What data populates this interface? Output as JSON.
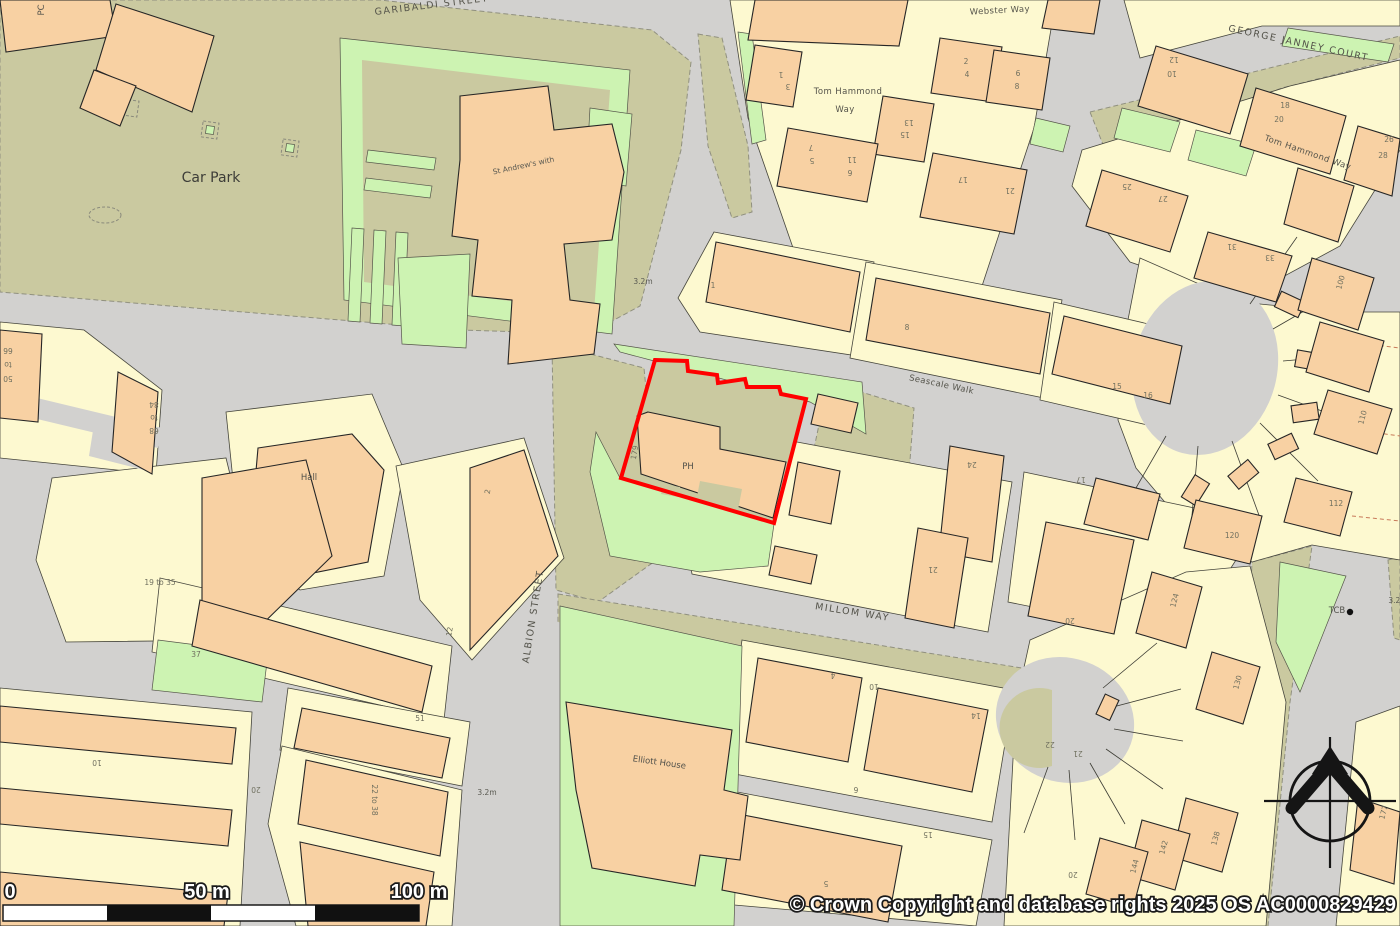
{
  "map": {
    "type": "ordnance-survey-site-plan",
    "copyright": "© Crown Copyright and database rights 2025 OS AC0000829429",
    "site": {
      "reference": "179",
      "building_label": "PH",
      "boundary_color": "#ff0000"
    },
    "streets": [
      "GARIBALDI STREET",
      "Webster Way",
      "GEORGE JANNEY COURT",
      "Tom Hammond Way",
      "Seascale Walk",
      "MILLOM WAY",
      "ALBION STREET"
    ],
    "places": [
      "Car Park",
      "St Andrew's with",
      "Hall",
      "Elliott House",
      "PC",
      "PH",
      "TCB"
    ],
    "spot_heights": [
      "3.2m"
    ]
  },
  "scale_bar": {
    "start": "0",
    "mid": "50 m",
    "end": "100 m"
  },
  "palette": {
    "road": "#d2d1cf",
    "parcel_khaki": "#cac9a0",
    "building_cream": "#fdf9d0",
    "building_orange": "#f8d1a3",
    "green_space": "#cdf3b2",
    "outline": "#262626",
    "boundary_red": "#ff0000"
  },
  "map_labels": [
    {
      "t": "GARIBALDI STREET",
      "x": 432,
      "y": 8,
      "r": -7,
      "c": "street"
    },
    {
      "t": "Webster Way",
      "x": 1000,
      "y": 13,
      "r": -3,
      "c": "street-sm"
    },
    {
      "t": "GEORGE JANNEY COURT",
      "x": 1298,
      "y": 46,
      "r": 12,
      "c": "street"
    },
    {
      "t": "Tom Hammond Way",
      "x": 1307,
      "y": 155,
      "r": 19,
      "c": "street-sm"
    },
    {
      "t": "Tom Hammond",
      "x": 848,
      "y": 94,
      "r": 0,
      "c": "street-sm"
    },
    {
      "t": "Way",
      "x": 845,
      "y": 112,
      "r": 0,
      "c": "street-sm"
    },
    {
      "t": "Seascale Walk",
      "x": 941,
      "y": 387,
      "r": 12,
      "c": "street-sm"
    },
    {
      "t": "MILLOM WAY",
      "x": 852,
      "y": 615,
      "r": 9,
      "c": "street"
    },
    {
      "t": "ALBION STREET",
      "x": 536,
      "y": 617,
      "r": -81,
      "c": "street"
    },
    {
      "t": "Car Park",
      "x": 211,
      "y": 182,
      "r": 0,
      "c": "area"
    },
    {
      "t": "St Andrew's with",
      "x": 524,
      "y": 168,
      "r": -12,
      "c": "tiny"
    },
    {
      "t": "Hall",
      "x": 309,
      "y": 480,
      "r": 0,
      "c": "small"
    },
    {
      "t": "Elliott House",
      "x": 659,
      "y": 765,
      "r": 8,
      "c": "small"
    },
    {
      "t": "PC",
      "x": 44,
      "y": 10,
      "r": -90,
      "c": "small"
    },
    {
      "t": "PH",
      "x": 688,
      "y": 469,
      "r": 0,
      "c": "small"
    },
    {
      "t": "TCB",
      "x": 1337,
      "y": 613,
      "r": 0,
      "c": "small"
    },
    {
      "t": "179",
      "x": 637,
      "y": 453,
      "r": -80,
      "c": "num"
    },
    {
      "t": "3.2m",
      "x": 643,
      "y": 284,
      "r": 0,
      "c": "tiny"
    },
    {
      "t": "3.2m",
      "x": 487,
      "y": 795,
      "r": 0,
      "c": "tiny"
    },
    {
      "t": "3.2m",
      "x": 1398,
      "y": 603,
      "r": 0,
      "c": "tiny"
    },
    {
      "t": "19 to 35",
      "x": 160,
      "y": 585,
      "r": 0,
      "c": "num"
    },
    {
      "t": "37",
      "x": 196,
      "y": 657,
      "r": 0,
      "c": "num"
    },
    {
      "t": "51",
      "x": 420,
      "y": 721,
      "r": 0,
      "c": "num"
    },
    {
      "t": "22 to 38",
      "x": 372,
      "y": 800,
      "r": 90,
      "c": "num"
    },
    {
      "t": "66",
      "x": 8,
      "y": 348,
      "r": 180,
      "c": "num"
    },
    {
      "t": "to",
      "x": 8,
      "y": 362,
      "r": 180,
      "c": "num"
    },
    {
      "t": "50",
      "x": 8,
      "y": 376,
      "r": 180,
      "c": "num"
    },
    {
      "t": "84",
      "x": 154,
      "y": 402,
      "r": 180,
      "c": "num"
    },
    {
      "t": "to",
      "x": 154,
      "y": 415,
      "r": 180,
      "c": "num"
    },
    {
      "t": "68",
      "x": 154,
      "y": 428,
      "r": 180,
      "c": "num"
    },
    {
      "t": "2",
      "x": 490,
      "y": 492,
      "r": -80,
      "c": "num"
    },
    {
      "t": "12",
      "x": 452,
      "y": 632,
      "r": -80,
      "c": "num"
    },
    {
      "t": "10",
      "x": 97,
      "y": 760,
      "r": 180,
      "c": "num"
    },
    {
      "t": "20",
      "x": 256,
      "y": 787,
      "r": 180,
      "c": "num"
    },
    {
      "t": "1",
      "x": 781,
      "y": 72,
      "r": 180,
      "c": "num"
    },
    {
      "t": "3",
      "x": 788,
      "y": 84,
      "r": 180,
      "c": "num"
    },
    {
      "t": "2",
      "x": 966,
      "y": 64,
      "r": 0,
      "c": "num"
    },
    {
      "t": "4",
      "x": 967,
      "y": 77,
      "r": 0,
      "c": "num"
    },
    {
      "t": "6",
      "x": 1018,
      "y": 76,
      "r": 0,
      "c": "num"
    },
    {
      "t": "8",
      "x": 1017,
      "y": 89,
      "r": 0,
      "c": "num"
    },
    {
      "t": "13",
      "x": 909,
      "y": 120,
      "r": 180,
      "c": "num"
    },
    {
      "t": "15",
      "x": 905,
      "y": 132,
      "r": 180,
      "c": "num"
    },
    {
      "t": "7",
      "x": 811,
      "y": 145,
      "r": 180,
      "c": "num"
    },
    {
      "t": "5",
      "x": 812,
      "y": 158,
      "r": 180,
      "c": "num"
    },
    {
      "t": "11",
      "x": 852,
      "y": 157,
      "r": 180,
      "c": "num"
    },
    {
      "t": "6",
      "x": 850,
      "y": 170,
      "r": 180,
      "c": "num"
    },
    {
      "t": "17",
      "x": 963,
      "y": 177,
      "r": 180,
      "c": "num"
    },
    {
      "t": "21",
      "x": 1010,
      "y": 188,
      "r": 180,
      "c": "num"
    },
    {
      "t": "12",
      "x": 1174,
      "y": 57,
      "r": 180,
      "c": "num"
    },
    {
      "t": "10",
      "x": 1172,
      "y": 71,
      "r": 180,
      "c": "num"
    },
    {
      "t": "18",
      "x": 1285,
      "y": 108,
      "r": 0,
      "c": "num"
    },
    {
      "t": "20",
      "x": 1279,
      "y": 122,
      "r": 0,
      "c": "num"
    },
    {
      "t": "26",
      "x": 1389,
      "y": 142,
      "r": 0,
      "c": "num"
    },
    {
      "t": "28",
      "x": 1383,
      "y": 158,
      "r": 0,
      "c": "num"
    },
    {
      "t": "25",
      "x": 1127,
      "y": 184,
      "r": 180,
      "c": "num"
    },
    {
      "t": "27",
      "x": 1163,
      "y": 196,
      "r": 180,
      "c": "num"
    },
    {
      "t": "31",
      "x": 1232,
      "y": 244,
      "r": 180,
      "c": "num"
    },
    {
      "t": "33",
      "x": 1270,
      "y": 255,
      "r": 180,
      "c": "num"
    },
    {
      "t": "100",
      "x": 1343,
      "y": 283,
      "r": -75,
      "c": "num"
    },
    {
      "t": "110",
      "x": 1365,
      "y": 418,
      "r": -75,
      "c": "num"
    },
    {
      "t": "112",
      "x": 1336,
      "y": 506,
      "r": 0,
      "c": "num"
    },
    {
      "t": "120",
      "x": 1232,
      "y": 538,
      "r": 0,
      "c": "num"
    },
    {
      "t": "8",
      "x": 907,
      "y": 330,
      "r": 0,
      "c": "num"
    },
    {
      "t": "1",
      "x": 713,
      "y": 288,
      "r": 0,
      "c": "num"
    },
    {
      "t": "15",
      "x": 1117,
      "y": 389,
      "r": 0,
      "c": "num"
    },
    {
      "t": "16",
      "x": 1148,
      "y": 398,
      "r": 0,
      "c": "num"
    },
    {
      "t": "24",
      "x": 972,
      "y": 462,
      "r": 180,
      "c": "num"
    },
    {
      "t": "21",
      "x": 933,
      "y": 567,
      "r": 180,
      "c": "num"
    },
    {
      "t": "17",
      "x": 1081,
      "y": 477,
      "r": 180,
      "c": "num"
    },
    {
      "t": "20",
      "x": 1070,
      "y": 618,
      "r": 180,
      "c": "num"
    },
    {
      "t": "22",
      "x": 1050,
      "y": 742,
      "r": 180,
      "c": "num"
    },
    {
      "t": "21",
      "x": 1078,
      "y": 751,
      "r": 180,
      "c": "num"
    },
    {
      "t": "124",
      "x": 1177,
      "y": 601,
      "r": -75,
      "c": "num"
    },
    {
      "t": "130",
      "x": 1240,
      "y": 683,
      "r": -75,
      "c": "num"
    },
    {
      "t": "138",
      "x": 1218,
      "y": 839,
      "r": -75,
      "c": "num"
    },
    {
      "t": "142",
      "x": 1166,
      "y": 848,
      "r": -75,
      "c": "num"
    },
    {
      "t": "144",
      "x": 1137,
      "y": 867,
      "r": -75,
      "c": "num"
    },
    {
      "t": "4",
      "x": 833,
      "y": 673,
      "r": 180,
      "c": "num"
    },
    {
      "t": "10",
      "x": 874,
      "y": 684,
      "r": 180,
      "c": "num"
    },
    {
      "t": "14",
      "x": 976,
      "y": 713,
      "r": 180,
      "c": "num"
    },
    {
      "t": "6",
      "x": 856,
      "y": 787,
      "r": 180,
      "c": "num"
    },
    {
      "t": "15",
      "x": 928,
      "y": 832,
      "r": 180,
      "c": "num"
    },
    {
      "t": "5",
      "x": 826,
      "y": 881,
      "r": 180,
      "c": "num"
    },
    {
      "t": "20",
      "x": 1073,
      "y": 872,
      "r": 180,
      "c": "num"
    },
    {
      "t": "177",
      "x": 1386,
      "y": 813,
      "r": -75,
      "c": "num"
    }
  ]
}
